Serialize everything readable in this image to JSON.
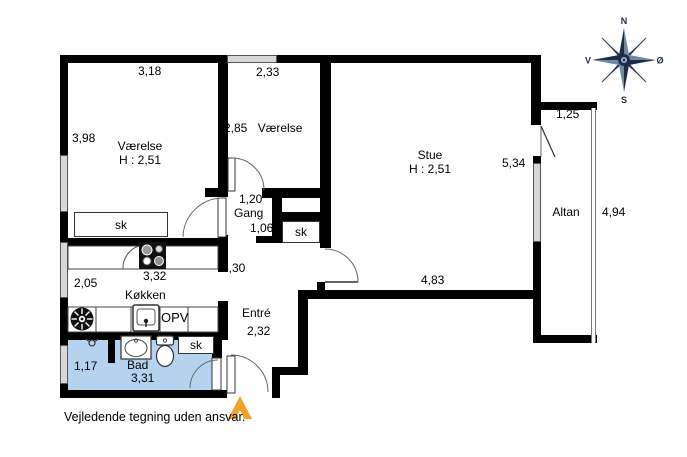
{
  "footer": {
    "disclaimer": "Vejledende tegning uden ansvar."
  },
  "compass": {
    "north": "N",
    "south": "S",
    "west": "V",
    "east": "Ø"
  },
  "rooms": {
    "vaerelse1": {
      "name": "Værelse",
      "ceiling_height": "H : 2,51",
      "dim_width": "3,18",
      "dim_depth": "3,98",
      "closet": "sk"
    },
    "vaerelse2": {
      "name": "Værelse",
      "dim_width": "2,33",
      "dim_depth": "2,85"
    },
    "stue": {
      "name": "Stue",
      "ceiling_height": "H : 2,51",
      "dim_width": "4,83",
      "dim_depth": "5,34"
    },
    "gang": {
      "name": "Gang",
      "dim_width": "1,20",
      "dim_passage": "1,06"
    },
    "koekken": {
      "name": "Køkken",
      "dim_width": "3,32",
      "dim_depth": "2,05",
      "dim_right": "3,30",
      "dishwasher": "OPV"
    },
    "entre": {
      "name": "Entré",
      "dim_width": "2,32",
      "closet": "sk"
    },
    "bad": {
      "name": "Bad",
      "dim_width": "3,31",
      "dim_depth": "1,17",
      "closet": "sk"
    },
    "altan": {
      "name": "Altan",
      "dim_width": "1,25",
      "dim_depth": "4,94"
    }
  },
  "colors": {
    "wall": "#000000",
    "bath_floor": "#b5d3ee",
    "window": "#d8d8d8",
    "entrance_arrow": "#f2a32b",
    "compass_dark": "#1d2c47",
    "compass_light": "#7189a3"
  }
}
